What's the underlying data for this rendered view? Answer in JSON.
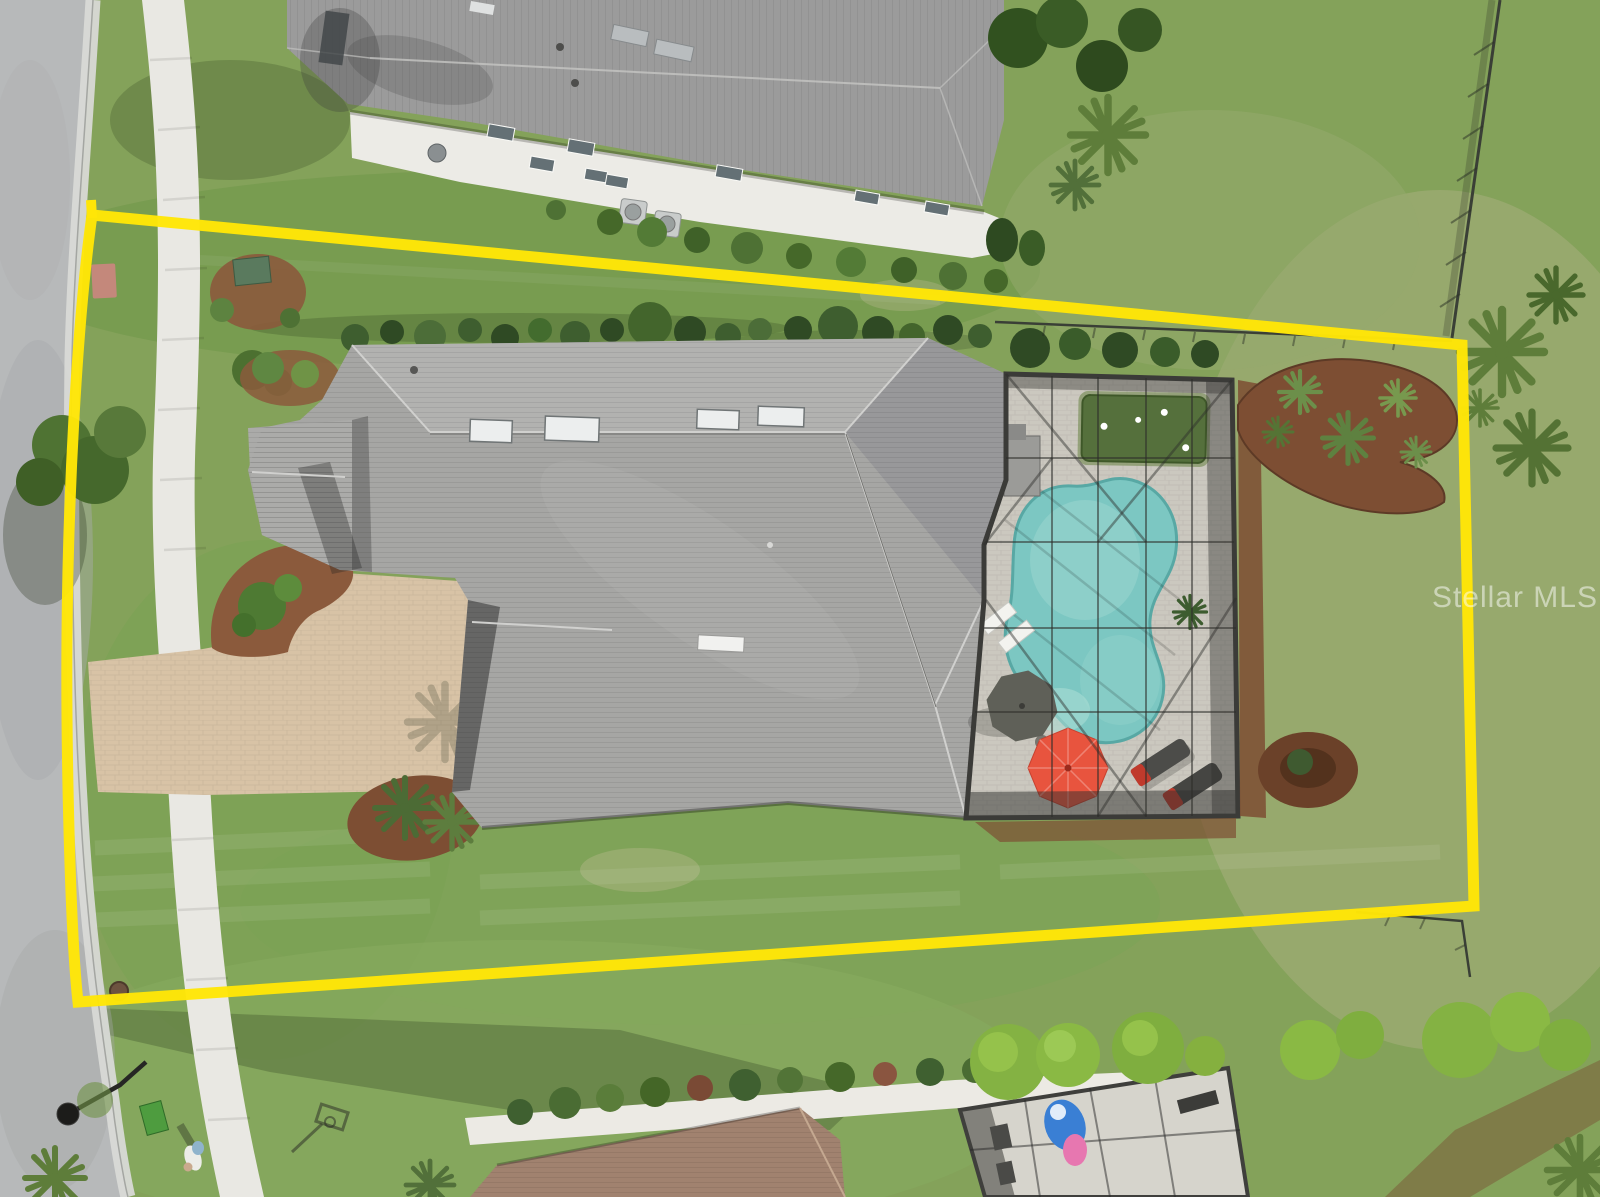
{
  "watermark": {
    "text": "Stellar MLS"
  },
  "colors": {
    "boundary_yellow": "#ffe607",
    "grass_base": "#84a25a",
    "grass_top_lawn": "#74994e",
    "grass_dry": "#a3ad7a",
    "road_asphalt": "#b7b9ba",
    "curb_concrete": "#d8d9d6",
    "sidewalk": "#e9e8e3",
    "driveway_pavers": "#d8c3a6",
    "main_roof_gray": "#a6a6a4",
    "main_roof_light": "#b2b2b0",
    "main_roof_dark": "#98989a",
    "neighbor_roof_gray": "#9b9b9b",
    "neighbor_wall_white": "#ecebe6",
    "neighbor_roof_brown": "#a1826f",
    "pool_water": "#7cc7c2",
    "pool_water_light": "#9ad6cf",
    "pool_deck": "#cbc8bf",
    "putting_green": "#55703c",
    "screen_frame": "#3b3b38",
    "umbrella_red": "#e8543e",
    "umbrella_gray": "#5f6058",
    "mulch_brown": "#8b5a3c",
    "mulch_dark": "#7d4e33",
    "hedge_green": "#3e5e2f",
    "bright_bush_green": "#84b243",
    "fence_dark": "#3a3f36",
    "lounger_dark": "#4c4c49",
    "lounger_red": "#c03a2c",
    "trash_can_green": "#4e9c3f",
    "pool_float_blue": "#3a7fd4",
    "pool_float_pink": "#e777b0"
  }
}
